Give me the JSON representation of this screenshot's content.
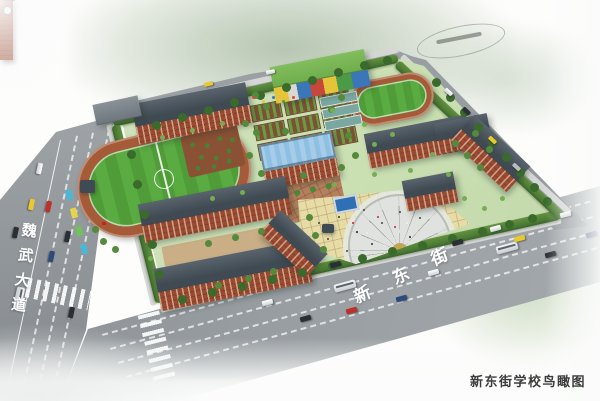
{
  "scene": {
    "caption": "新东街学校鸟瞰图",
    "road_labels": {
      "left_road": "魏武大道",
      "bottom_road": "新东街"
    }
  },
  "palette": {
    "road": "#8f959a",
    "campus_green": "#cadfb2",
    "hedge": "#4a7a34",
    "track_surface": "#a65b38",
    "field_green": "#4f9c38",
    "brick": "#9a4a30",
    "roof_dark": "#3f4a53",
    "glass_blue": "#8fc0e2",
    "kinder_roof": "#6fae4c",
    "plaza_paving": "#e7dba6",
    "fan_gray": "#dfe2de",
    "soil": "#7c5233",
    "courtyard_tan": "#c9ae86",
    "caption_text": "#3c3c3c"
  }
}
